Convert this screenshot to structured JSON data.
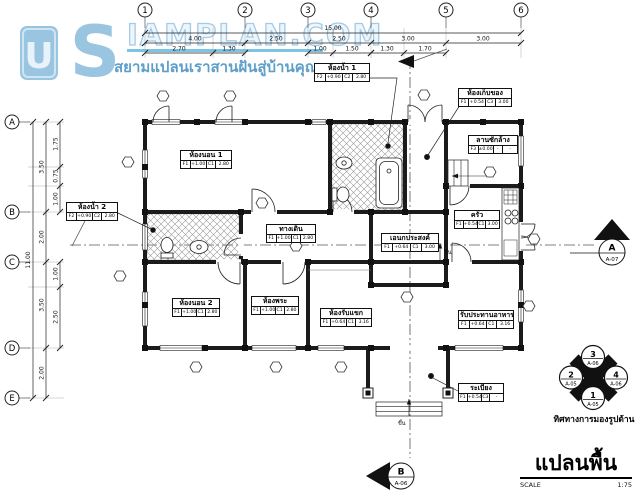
{
  "watermark": {
    "logo_letter_u": "U",
    "logo_letter_s": "S",
    "brand": "IAMPLAN.COM",
    "tagline": "สยามแปลนเราสานฝันสู่บ้านคุณ",
    "colors": {
      "logo_blue": "#9ac5e1",
      "tagline_blue": "#5f9ec9",
      "underline_cyan": "#7cc4e4"
    }
  },
  "title_block": {
    "title": "แปลนพื้น",
    "scale_label": "SCALE",
    "scale_value": "1:75"
  },
  "compass": {
    "caption": "ทิศทางการมองรูปด้าน",
    "nodes": [
      {
        "num": "3",
        "sheet": "A-06",
        "pos": "top"
      },
      {
        "num": "2",
        "sheet": "A-05",
        "pos": "left"
      },
      {
        "num": "4",
        "sheet": "A-06",
        "pos": "right"
      },
      {
        "num": "1",
        "sheet": "A-05",
        "pos": "bottom"
      }
    ]
  },
  "grid": {
    "columns": [
      "1",
      "2",
      "3",
      "4",
      "5",
      "6"
    ],
    "rows": [
      "A",
      "B",
      "C",
      "D",
      "E"
    ]
  },
  "dimensions": {
    "total_width": "15.00",
    "top_level2": [
      "4.00",
      "2.50",
      "2.50",
      "3.00",
      "3.00"
    ],
    "top_level3_seg1": [
      "2.70",
      "1.30"
    ],
    "top_level3_seg2": [
      "1.00",
      "1.50"
    ],
    "top_level3_seg3": [
      "1.30",
      "1.70"
    ],
    "total_height": "11.00",
    "left_level2": [
      "3.50",
      "2.00",
      "3.50",
      "2.00"
    ],
    "left_level3_seg1": [
      "1.75",
      "0.75",
      "1.00"
    ],
    "left_level3_seg2": [
      "1.00",
      "2.50"
    ]
  },
  "rooms": [
    {
      "name": "ห้องนอน 1",
      "f": "F1",
      "fv": "+1.00",
      "c": "C1",
      "cv": "2.80"
    },
    {
      "name": "ห้องน้ำ 1",
      "f": "F2",
      "fv": "+0.90",
      "c": "C2",
      "cv": "2.80"
    },
    {
      "name": "ห้องเก็บของ",
      "f": "F1",
      "fv": "+0.54",
      "c": "C3",
      "cv": "3.00"
    },
    {
      "name": "ลานซักล้าง",
      "f": "F3",
      "fv": "±0.00",
      "c": "-",
      "cv": "-"
    },
    {
      "name": "ครัว",
      "f": "F1",
      "fv": "+0.54",
      "c": "C1",
      "cv": "3.00"
    },
    {
      "name": "ห้องน้ำ 2",
      "f": "F2",
      "fv": "+0.90",
      "c": "C2",
      "cv": "2.80"
    },
    {
      "name": "ทางเดิน",
      "f": "F1",
      "fv": "+1.00",
      "c": "C1",
      "cv": "2.80"
    },
    {
      "name": "เอนกประสงค์",
      "f": "F1",
      "fv": "+0.64",
      "c": "C1",
      "cv": "3.00"
    },
    {
      "name": "ห้องนอน 2",
      "f": "F1",
      "fv": "+1.00",
      "c": "C1",
      "cv": "2.80"
    },
    {
      "name": "ห้องพระ",
      "f": "F1",
      "fv": "+1.00",
      "c": "C1",
      "cv": "2.80"
    },
    {
      "name": "ห้องรับแขก",
      "f": "F1",
      "fv": "+0.64",
      "c": "C1",
      "cv": "3.16"
    },
    {
      "name": "รับประทานอาหาร",
      "f": "F1",
      "fv": "+0.64",
      "c": "C1",
      "cv": "3.16"
    },
    {
      "name": "ระเบียง",
      "f": "F1",
      "fv": "+0.54",
      "c": "C3",
      "cv": "-"
    }
  ],
  "markers": {
    "section_a": {
      "letter": "A",
      "sheet": "A-07"
    },
    "section_b": {
      "letter": "B",
      "sheet": "A-06"
    }
  },
  "annotations": {
    "up_label": "ขึ้น"
  }
}
